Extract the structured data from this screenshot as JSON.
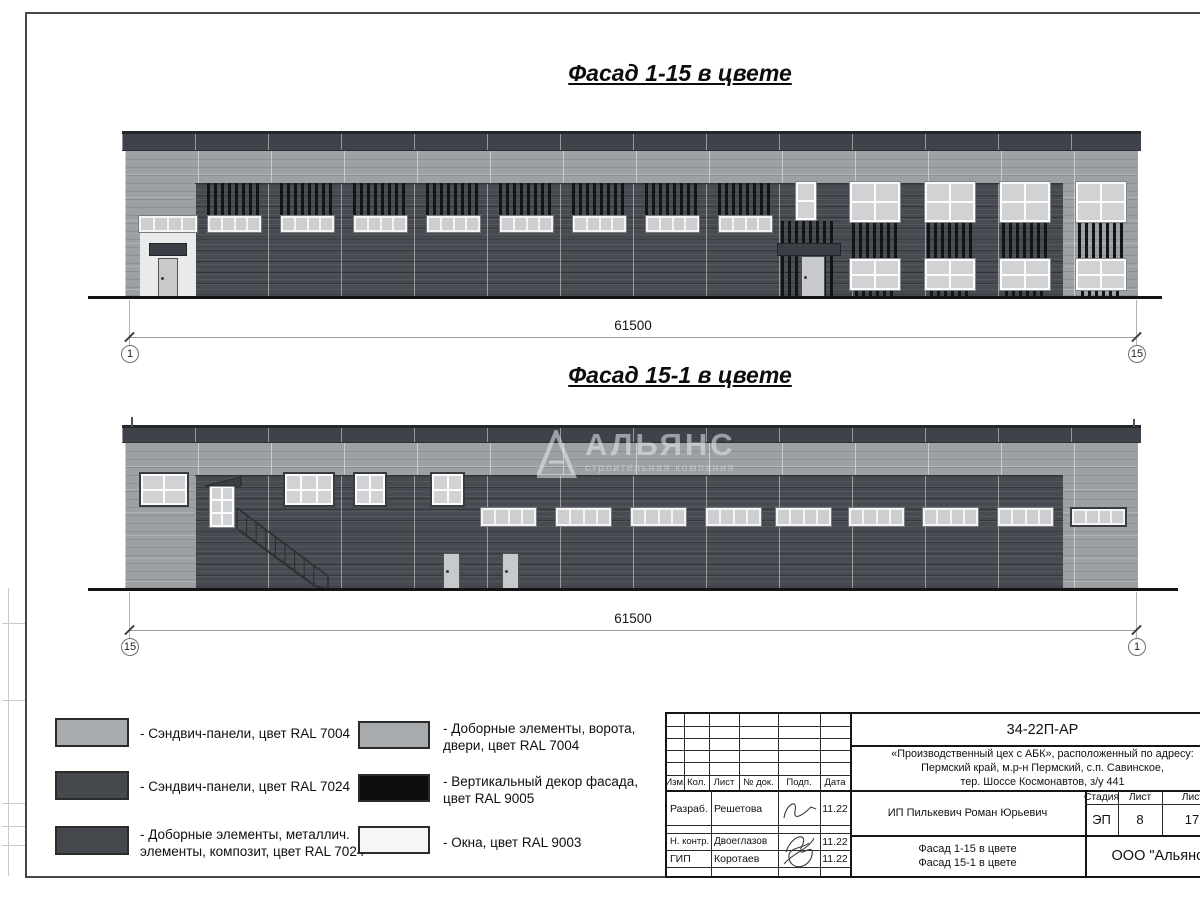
{
  "titles": {
    "facade1": "Фасад 1-15 в цвете",
    "facade2": "Фасад 15-1 в цвете"
  },
  "dims": {
    "f1": {
      "value": "61500",
      "axis_left": "1",
      "axis_right": "15"
    },
    "f2": {
      "value": "61500",
      "axis_left": "15",
      "axis_right": "1"
    }
  },
  "watermark": {
    "name": "АЛЬЯНС",
    "tagline": "строительная компания"
  },
  "colors": {
    "ral7004": "#a7abad",
    "ral7024": "#45494e",
    "ral9005": "#0c0d0e",
    "ral9003": "#f6f7f7"
  },
  "legend": {
    "left": [
      {
        "color": "#a7abad",
        "label": "- Сэндвич-панели, цвет RAL 7004"
      },
      {
        "color": "#45494e",
        "label": "- Сэндвич-панели, цвет RAL 7024"
      },
      {
        "color": "#45494e",
        "label": "- Доборные элементы, металлич.\nэлементы, композит, цвет RAL 7024"
      }
    ],
    "right": [
      {
        "color": "#a7abad",
        "label": "- Доборные элементы, ворота,\nдвери, цвет RAL 7004"
      },
      {
        "color": "#0c0d0e",
        "label": "- Вертикальный декор фасада,\nцвет RAL 9005"
      },
      {
        "color": "#f6f7f7",
        "label": "- Окна, цвет RAL 9003"
      }
    ]
  },
  "titleblock": {
    "doc_code": "34-22П-АР",
    "project": "«Производственный цех с АБК», расположенный по адресу:\nПермский край, м.р-н Пермский, с.п. Савинское,\nтер. Шоссе Космонавтов, з/у 441",
    "columns": [
      "Изм.",
      "Кол.",
      "Лист",
      "№ док.",
      "Подп.",
      "Дата"
    ],
    "rows": [
      {
        "role": "Разраб.",
        "name": "Решетова",
        "date": "11.22"
      },
      {
        "role": "Н. контр.",
        "name": "Двоеглазов",
        "date": "11.22"
      },
      {
        "role": "ГИП",
        "name": "Коротаев",
        "date": "11.22"
      }
    ],
    "client": "ИП Пилькевич Роман Юрьевич",
    "sheet_title": "Фасад 1-15 в цвете\nФасад 15-1 в цвете",
    "stage_label": "Стадия",
    "sheet_label": "Лист",
    "sheets_label": "Листов",
    "stage": "ЭП",
    "sheet": "8",
    "sheets": "17",
    "company": "ООО \"Альянс\""
  },
  "facade_specs": {
    "f1": {
      "industrial_windows": 8,
      "abk_window_columns": 4
    },
    "f2": {
      "strip_windows": 8
    }
  }
}
